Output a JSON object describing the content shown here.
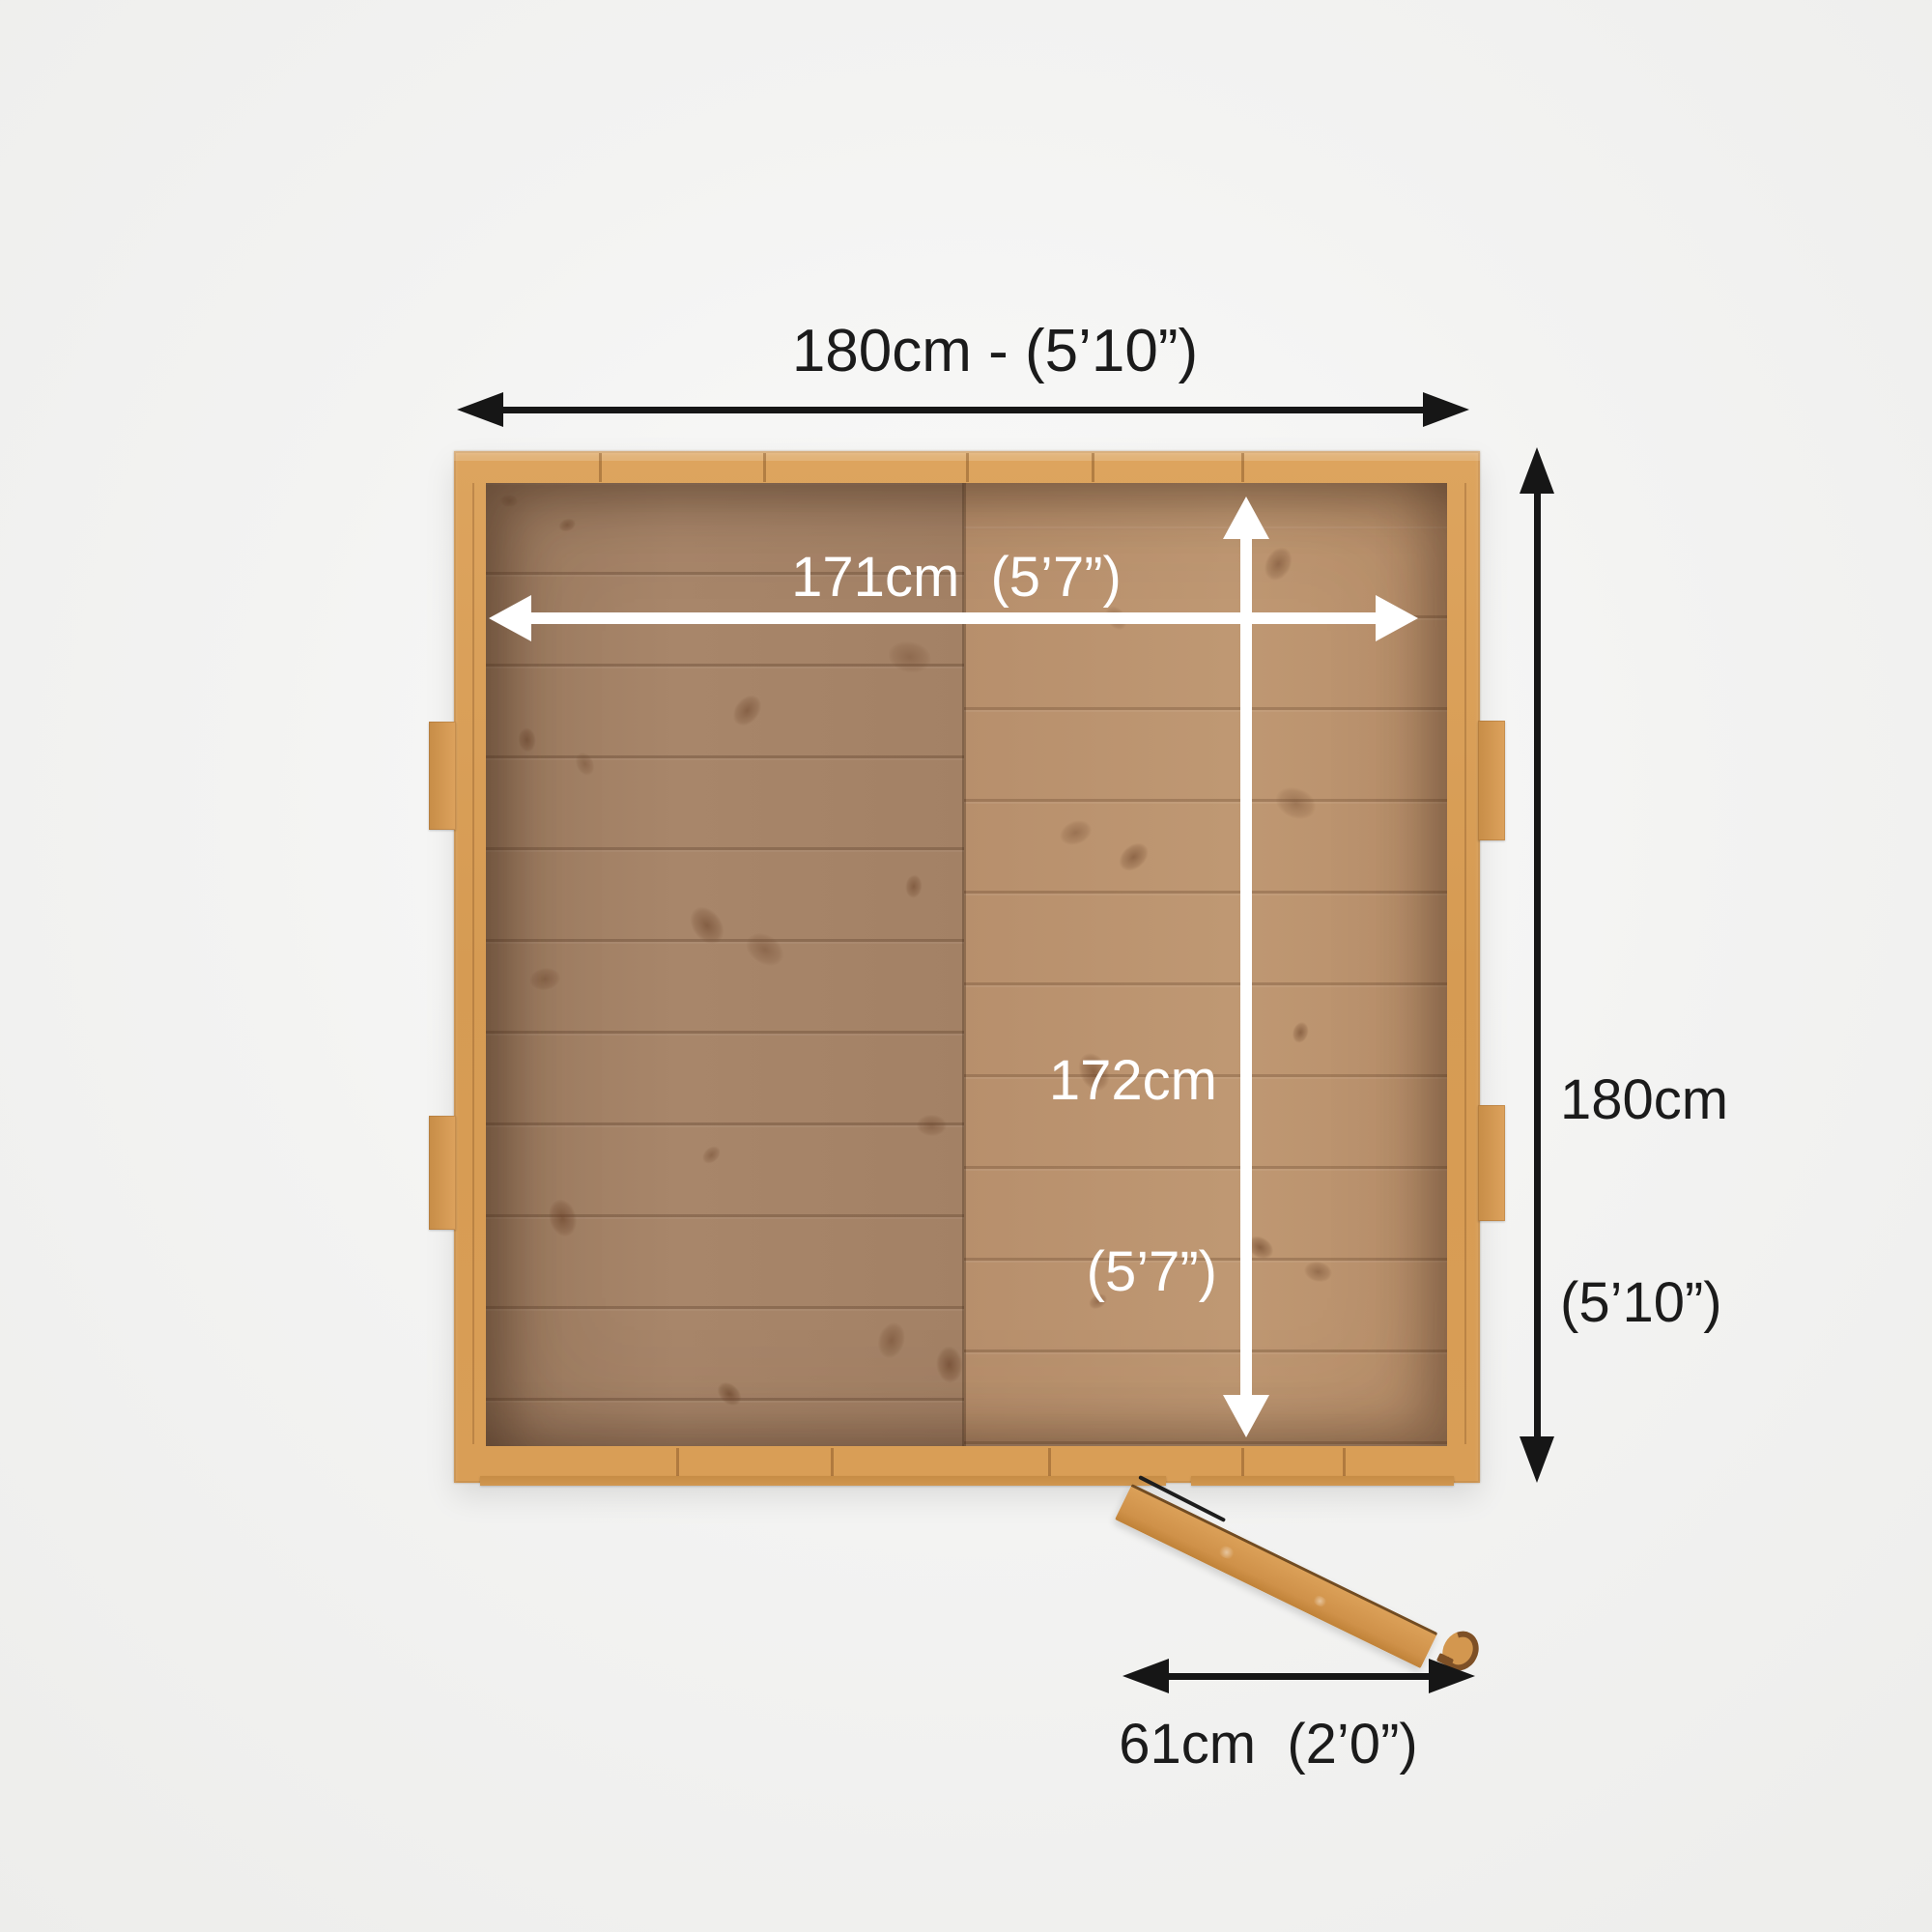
{
  "diagram": {
    "type": "shed-floorplan-top-view",
    "dimensions": {
      "outer_width": {
        "label": "180cm - (5’10”)"
      },
      "outer_depth": {
        "line1": "180cm",
        "line2": "(5’10”)"
      },
      "inner_width": {
        "label": "171cm  (5’7”)"
      },
      "inner_depth": {
        "line1": "172cm",
        "line2": "(5’7”)"
      },
      "door_width": {
        "label": "61cm  (2’0”)"
      }
    },
    "colors": {
      "background": "#f3f3f2",
      "frame_wood": "#d99e56",
      "floor_left": "#a5846a",
      "floor_right": "#bd9772",
      "arrow_black": "#161616",
      "arrow_white": "#ffffff",
      "label_black": "#1b1b1b",
      "label_white": "#ffffff"
    }
  }
}
